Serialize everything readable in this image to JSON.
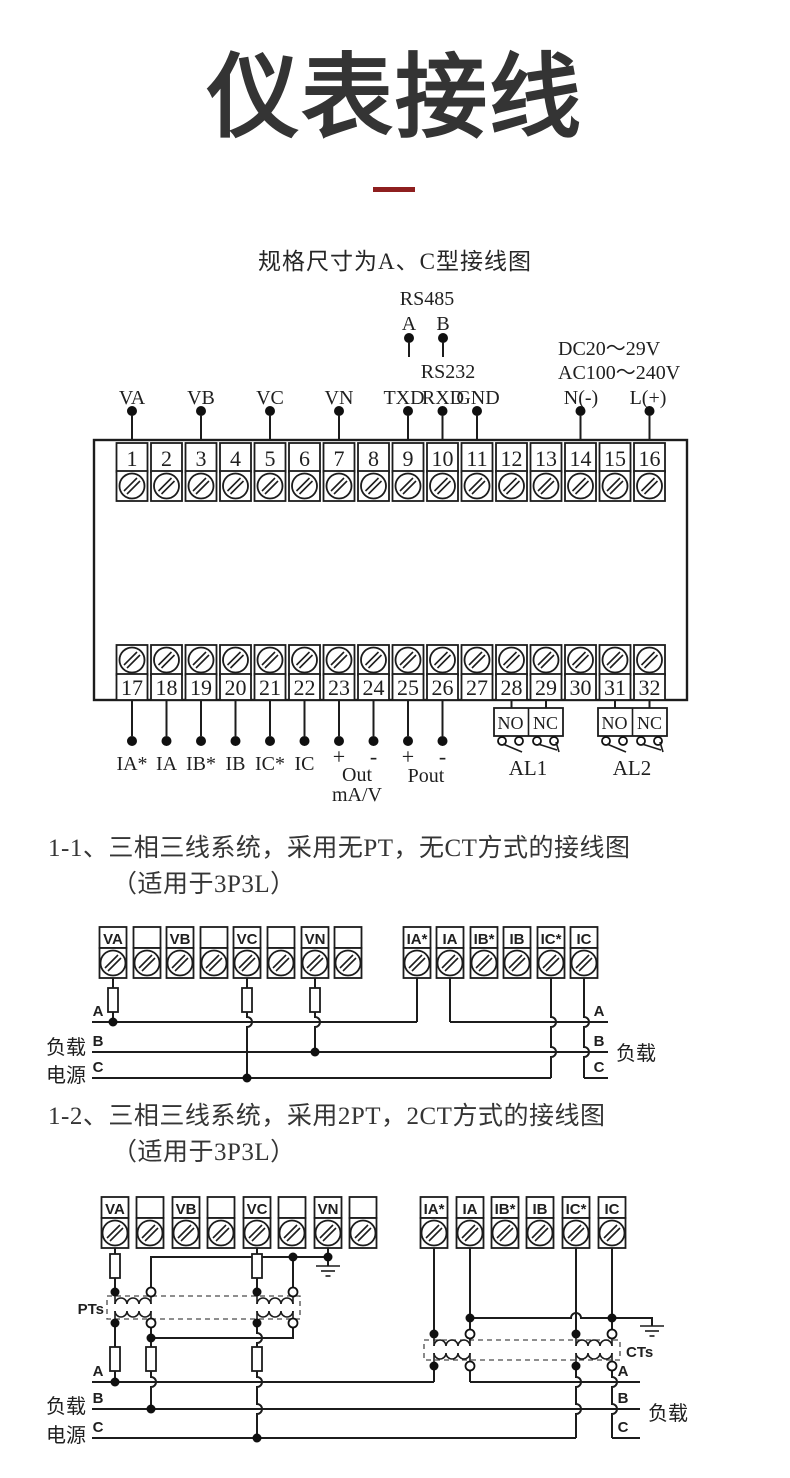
{
  "page": {
    "title": "仪表接线",
    "subtitle": "规格尺寸为A、C型接线图",
    "accent_red": "#8e1f1f"
  },
  "section1": {
    "heading": "1-1、三相三线系统，采用无PT，无CT方式的接线图",
    "subheading": "（适用于3P3L）"
  },
  "section2": {
    "heading": "1-2、三相三线系统，采用2PT，2CT方式的接线图",
    "subheading": "（适用于3P3L）"
  },
  "top_diagram": {
    "rs485": {
      "label": "RS485",
      "a": "A",
      "b": "B"
    },
    "rs232": {
      "label": "RS232",
      "txd": "TXD",
      "rxd": "RXD",
      "gnd": "GND"
    },
    "power": {
      "dc": "DC20～29V",
      "ac": "AC100～240V",
      "n": "N(-)",
      "l": "L(+)"
    },
    "voltage_labels": [
      "VA",
      "VB",
      "VC",
      "VN"
    ],
    "terminals_top": [
      "1",
      "2",
      "3",
      "4",
      "5",
      "6",
      "7",
      "8",
      "9",
      "10",
      "11",
      "12",
      "13",
      "14",
      "15",
      "16"
    ],
    "terminals_bottom": [
      "17",
      "18",
      "19",
      "20",
      "21",
      "22",
      "23",
      "24",
      "25",
      "26",
      "27",
      "28",
      "29",
      "30",
      "31",
      "32"
    ],
    "current_labels": [
      "IA*",
      "IA",
      "IB*",
      "IB",
      "IC*",
      "IC"
    ],
    "analog": {
      "plus1": "+",
      "minus1": "-",
      "out": "Out",
      "unit": "mA/V",
      "plus2": "+",
      "minus2": "-",
      "pout": "Pout"
    },
    "relay1": {
      "no": "NO",
      "nc": "NC",
      "name": "AL1"
    },
    "relay2": {
      "no": "NO",
      "nc": "NC",
      "name": "AL2"
    }
  },
  "diagram1": {
    "volt_terminals": [
      "VA",
      "",
      "VB",
      "",
      "VC",
      "",
      "VN",
      ""
    ],
    "curr_terminals": [
      "IA*",
      "IA",
      "IB*",
      "IB",
      "IC*",
      "IC"
    ],
    "phases": [
      "A",
      "B",
      "C"
    ],
    "source_label_1": "负载",
    "source_label_2": "电源",
    "load_label": "负载"
  },
  "diagram2": {
    "volt_terminals": [
      "VA",
      "",
      "VB",
      "",
      "VC",
      "",
      "VN",
      ""
    ],
    "curr_terminals": [
      "IA*",
      "IA",
      "IB*",
      "IB",
      "IC*",
      "IC"
    ],
    "phases": [
      "A",
      "B",
      "C"
    ],
    "source_label_1": "负载",
    "source_label_2": "电源",
    "load_label": "负载",
    "pts": "PTs",
    "cts": "CTs"
  }
}
